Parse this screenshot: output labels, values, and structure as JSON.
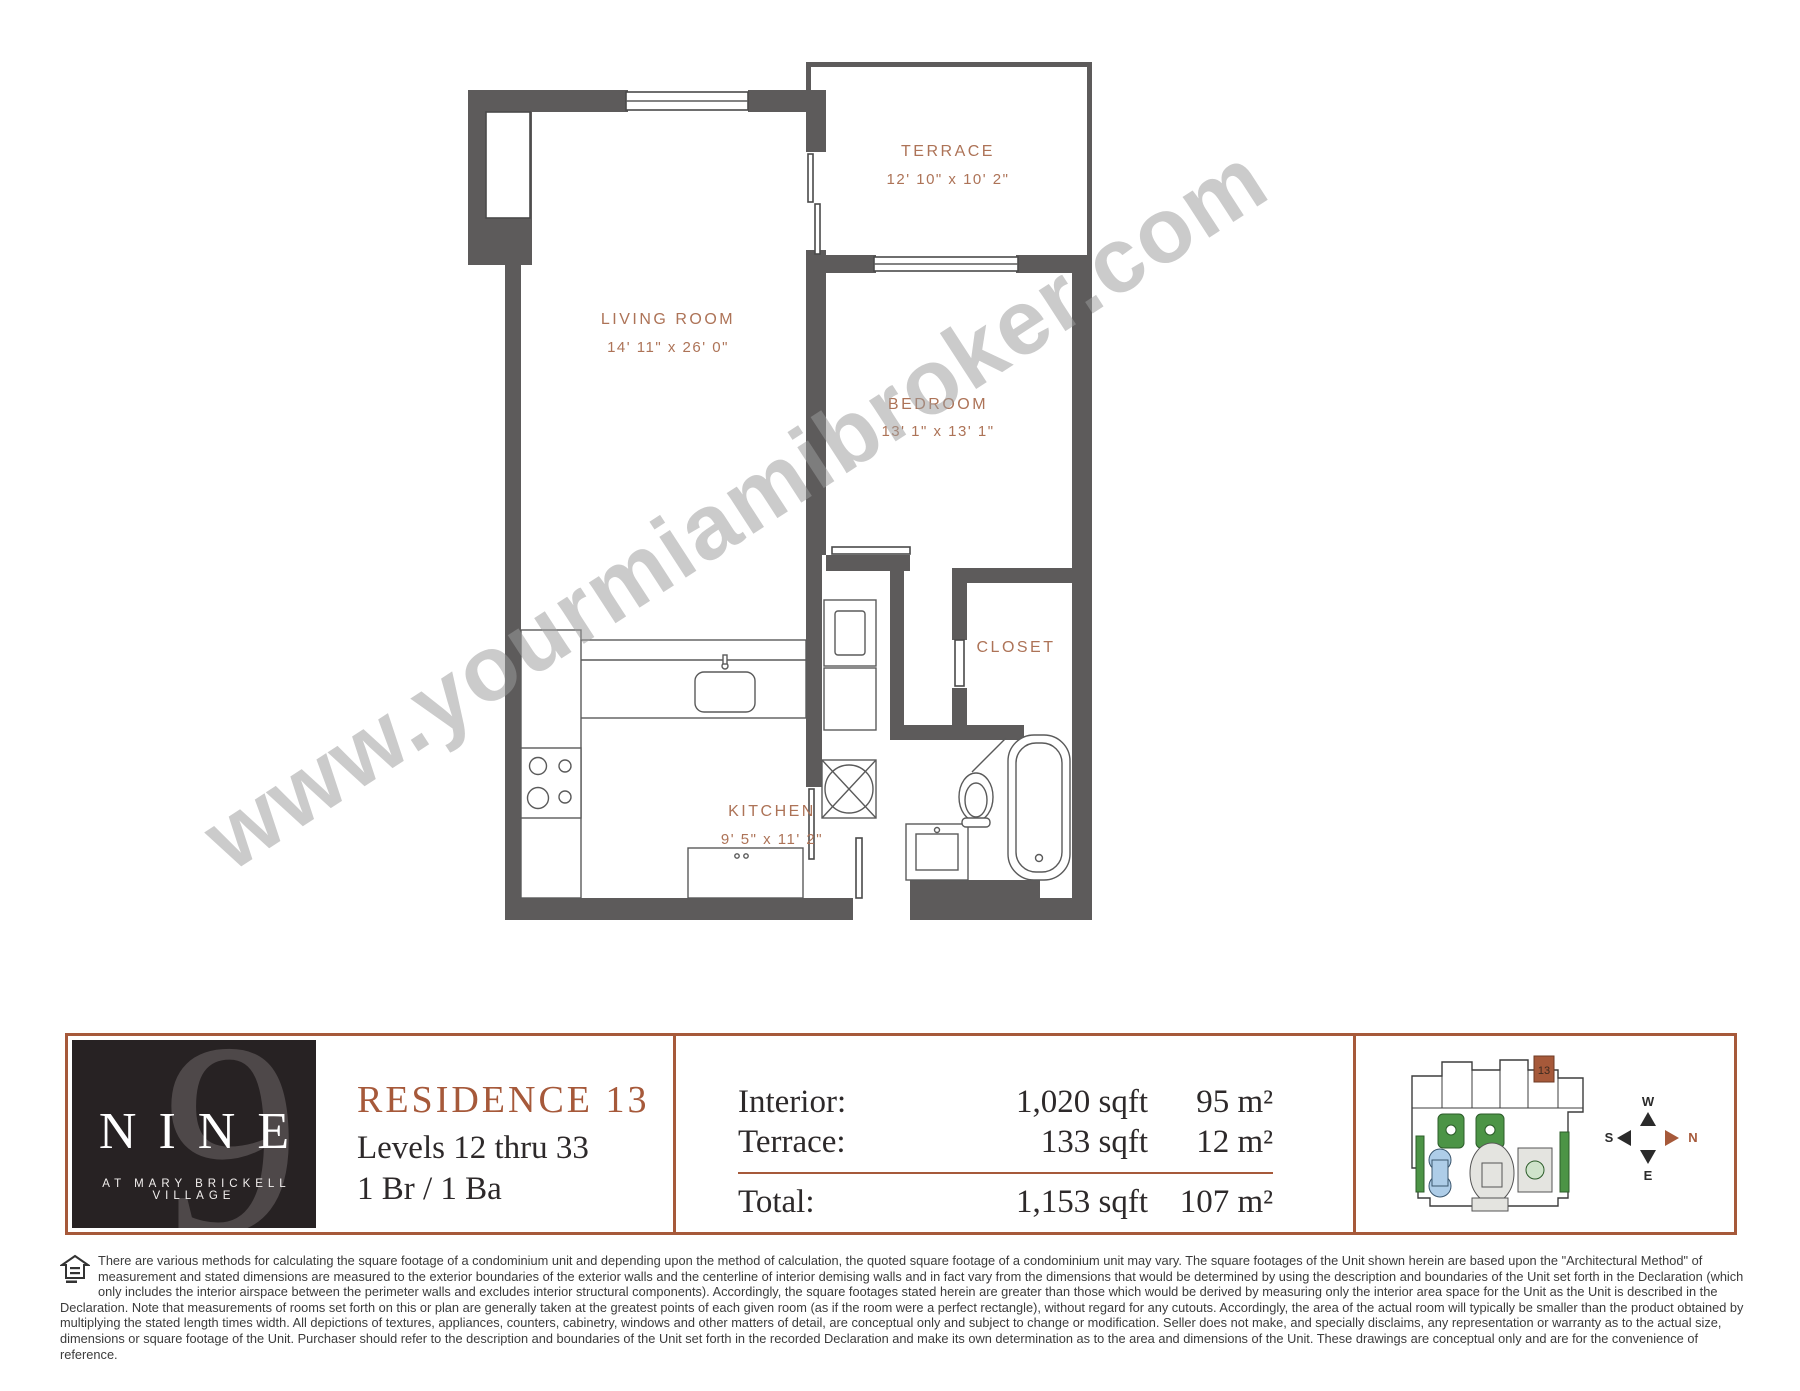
{
  "plan": {
    "rooms": {
      "terrace": {
        "name": "TERRACE",
        "dims": "12' 10\" x 10' 2\""
      },
      "living": {
        "name": "LIVING ROOM",
        "dims": "14' 11\" x 26' 0\""
      },
      "bedroom": {
        "name": "BEDROOM",
        "dims": "13' 1\" x 13' 1\""
      },
      "closet": {
        "name": "CLOSET"
      },
      "kitchen": {
        "name": "KITCHEN",
        "dims": "9' 5\" x 11' 2\""
      }
    }
  },
  "watermark": {
    "text": "www.yourmiamibroker.com"
  },
  "logo": {
    "numeral": "9",
    "name": "NINE",
    "tagline": "AT MARY BRICKELL VILLAGE"
  },
  "residence": {
    "title": "RESIDENCE 13",
    "levels": "Levels 12 thru 33",
    "bed_bath": "1 Br / 1 Ba"
  },
  "areas": {
    "interior_label": "Interior:",
    "interior_sqft": "1,020 sqft",
    "interior_sqm": "95 m²",
    "terrace_label": "Terrace:",
    "terrace_sqft": "133 sqft",
    "terrace_sqm": "12 m²",
    "total_label": "Total:",
    "total_sqft": "1,153 sqft",
    "total_sqm": "107 m²"
  },
  "keyplan": {
    "unit": "13"
  },
  "compass": {
    "top": "W",
    "right": "N",
    "left": "S",
    "bottom": "E"
  },
  "disclaimer": "There are various methods for calculating the square footage of a condominium unit and depending upon the method of calculation, the quoted square footage of a condominium unit may vary. The square footages of the Unit shown herein are based upon the \"Architectural Method\" of measurement and stated dimensions are measured to the exterior boundaries of the exterior walls and the centerline of interior demising walls and in fact vary from the dimensions that would be determined by using the description and boundaries of the Unit set forth in the Declaration (which only includes the interior airspace between the perimeter walls and excludes interior structural components). Accordingly, the square footages stated herein are greater than those which would be derived by measuring only the interior area space for the Unit as the Unit is described in the Declaration. Note that measurements of rooms set forth on this or plan are generally taken at the greatest points of each given room (as if the room were a perfect rectangle), without regard for any cutouts. Accordingly, the area of the actual room will typically be smaller than the product obtained by multiplying the stated length times width. All depictions of textures, appliances, counters, cabinetry, windows and other matters of detail, are conceptual only and subject to change or modification. Seller does not make, and specially disclaims, any representation or warranty as to the actual size, dimensions or square footage of the Unit. Purchaser should refer to the description and boundaries of the Unit set forth in the recorded Declaration and make its own determination as to the area and dimensions of the Unit. These drawings are conceptual only and are for the convenience of reference.",
  "colors": {
    "accent": "#a6593a",
    "wall": "#5d5b5b",
    "label": "#ad7357",
    "logo_bg": "#272223"
  }
}
